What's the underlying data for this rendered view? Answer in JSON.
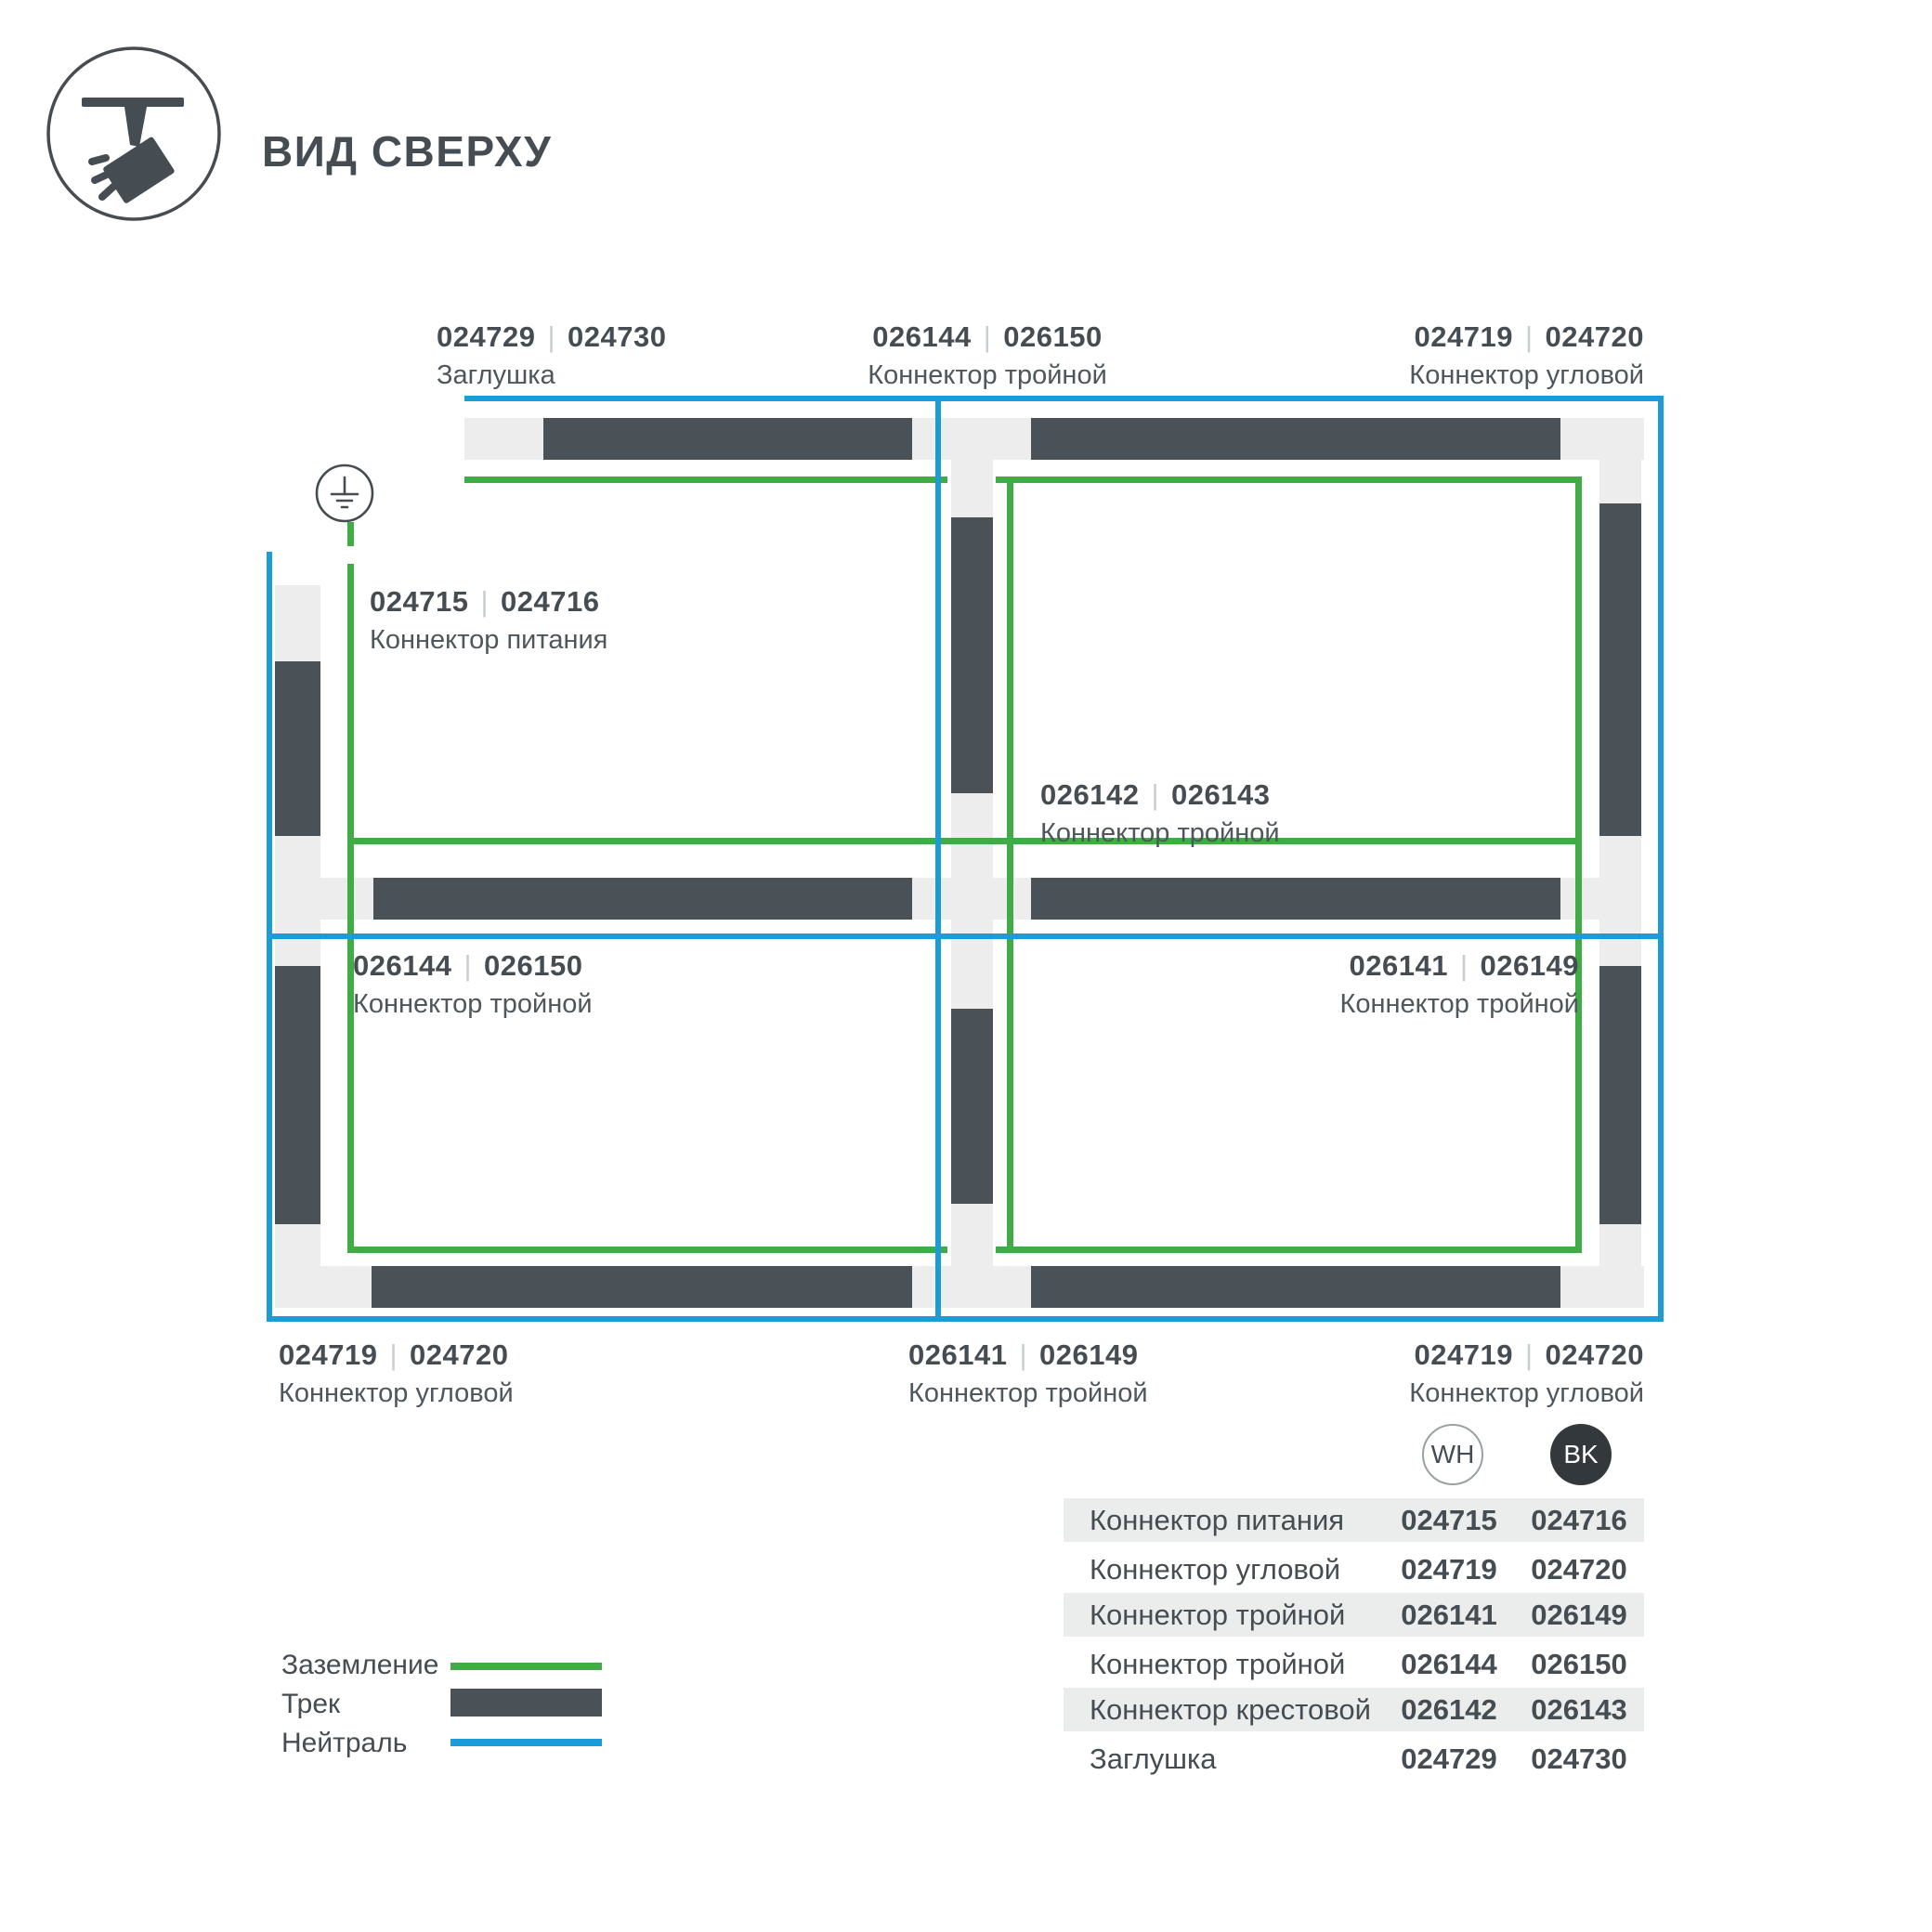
{
  "sep": "|",
  "header": {
    "title": "ВИД СВЕРХУ"
  },
  "colors": {
    "dark": "#454D52",
    "track": "#4A5257",
    "conn": "#ECEDEC",
    "green": "#41AB45",
    "blue": "#1B9CD8",
    "tablegray": "#EBEDEC",
    "bkfill": "#33383C",
    "sepgray": "#C8CDCD",
    "namegray": "#4E575C",
    "badgeline": "#9AA1A5"
  },
  "labels": [
    {
      "code1": "024729",
      "code2": "024730",
      "name": "Заглушка"
    },
    {
      "code1": "026144",
      "code2": "026150",
      "name": "Коннектор тройной"
    },
    {
      "code1": "024719",
      "code2": "024720",
      "name": "Коннектор угловой"
    },
    {
      "code1": "024715",
      "code2": "024716",
      "name": "Коннектор питания"
    },
    {
      "code1": "026142",
      "code2": "026143",
      "name": "Коннектор тройной"
    },
    {
      "code1": "026144",
      "code2": "026150",
      "name": "Коннектор тройной"
    },
    {
      "code1": "026141",
      "code2": "026149",
      "name": "Коннектор тройной"
    },
    {
      "code1": "024719",
      "code2": "024720",
      "name": "Коннектор угловой"
    },
    {
      "code1": "026141",
      "code2": "026149",
      "name": "Коннектор тройной"
    },
    {
      "code1": "024719",
      "code2": "024720",
      "name": "Коннектор угловой"
    }
  ],
  "legend": {
    "items": [
      {
        "label": "Заземление"
      },
      {
        "label": "Трек"
      },
      {
        "label": "Нейтраль"
      }
    ]
  },
  "table": {
    "badges": {
      "wh": "WH",
      "bk": "BK"
    },
    "rows": [
      {
        "name": "Коннектор питания",
        "wh": "024715",
        "bk": "024716"
      },
      {
        "name": "Коннектор угловой",
        "wh": "024719",
        "bk": "024720"
      },
      {
        "name": "Коннектор тройной",
        "wh": "026141",
        "bk": "026149"
      },
      {
        "name": "Коннектор тройной",
        "wh": "026144",
        "bk": "026150"
      },
      {
        "name": "Коннектор крестовой",
        "wh": "026142",
        "bk": "026143"
      },
      {
        "name": "Заглушка",
        "wh": "024729",
        "bk": "024730"
      }
    ]
  }
}
